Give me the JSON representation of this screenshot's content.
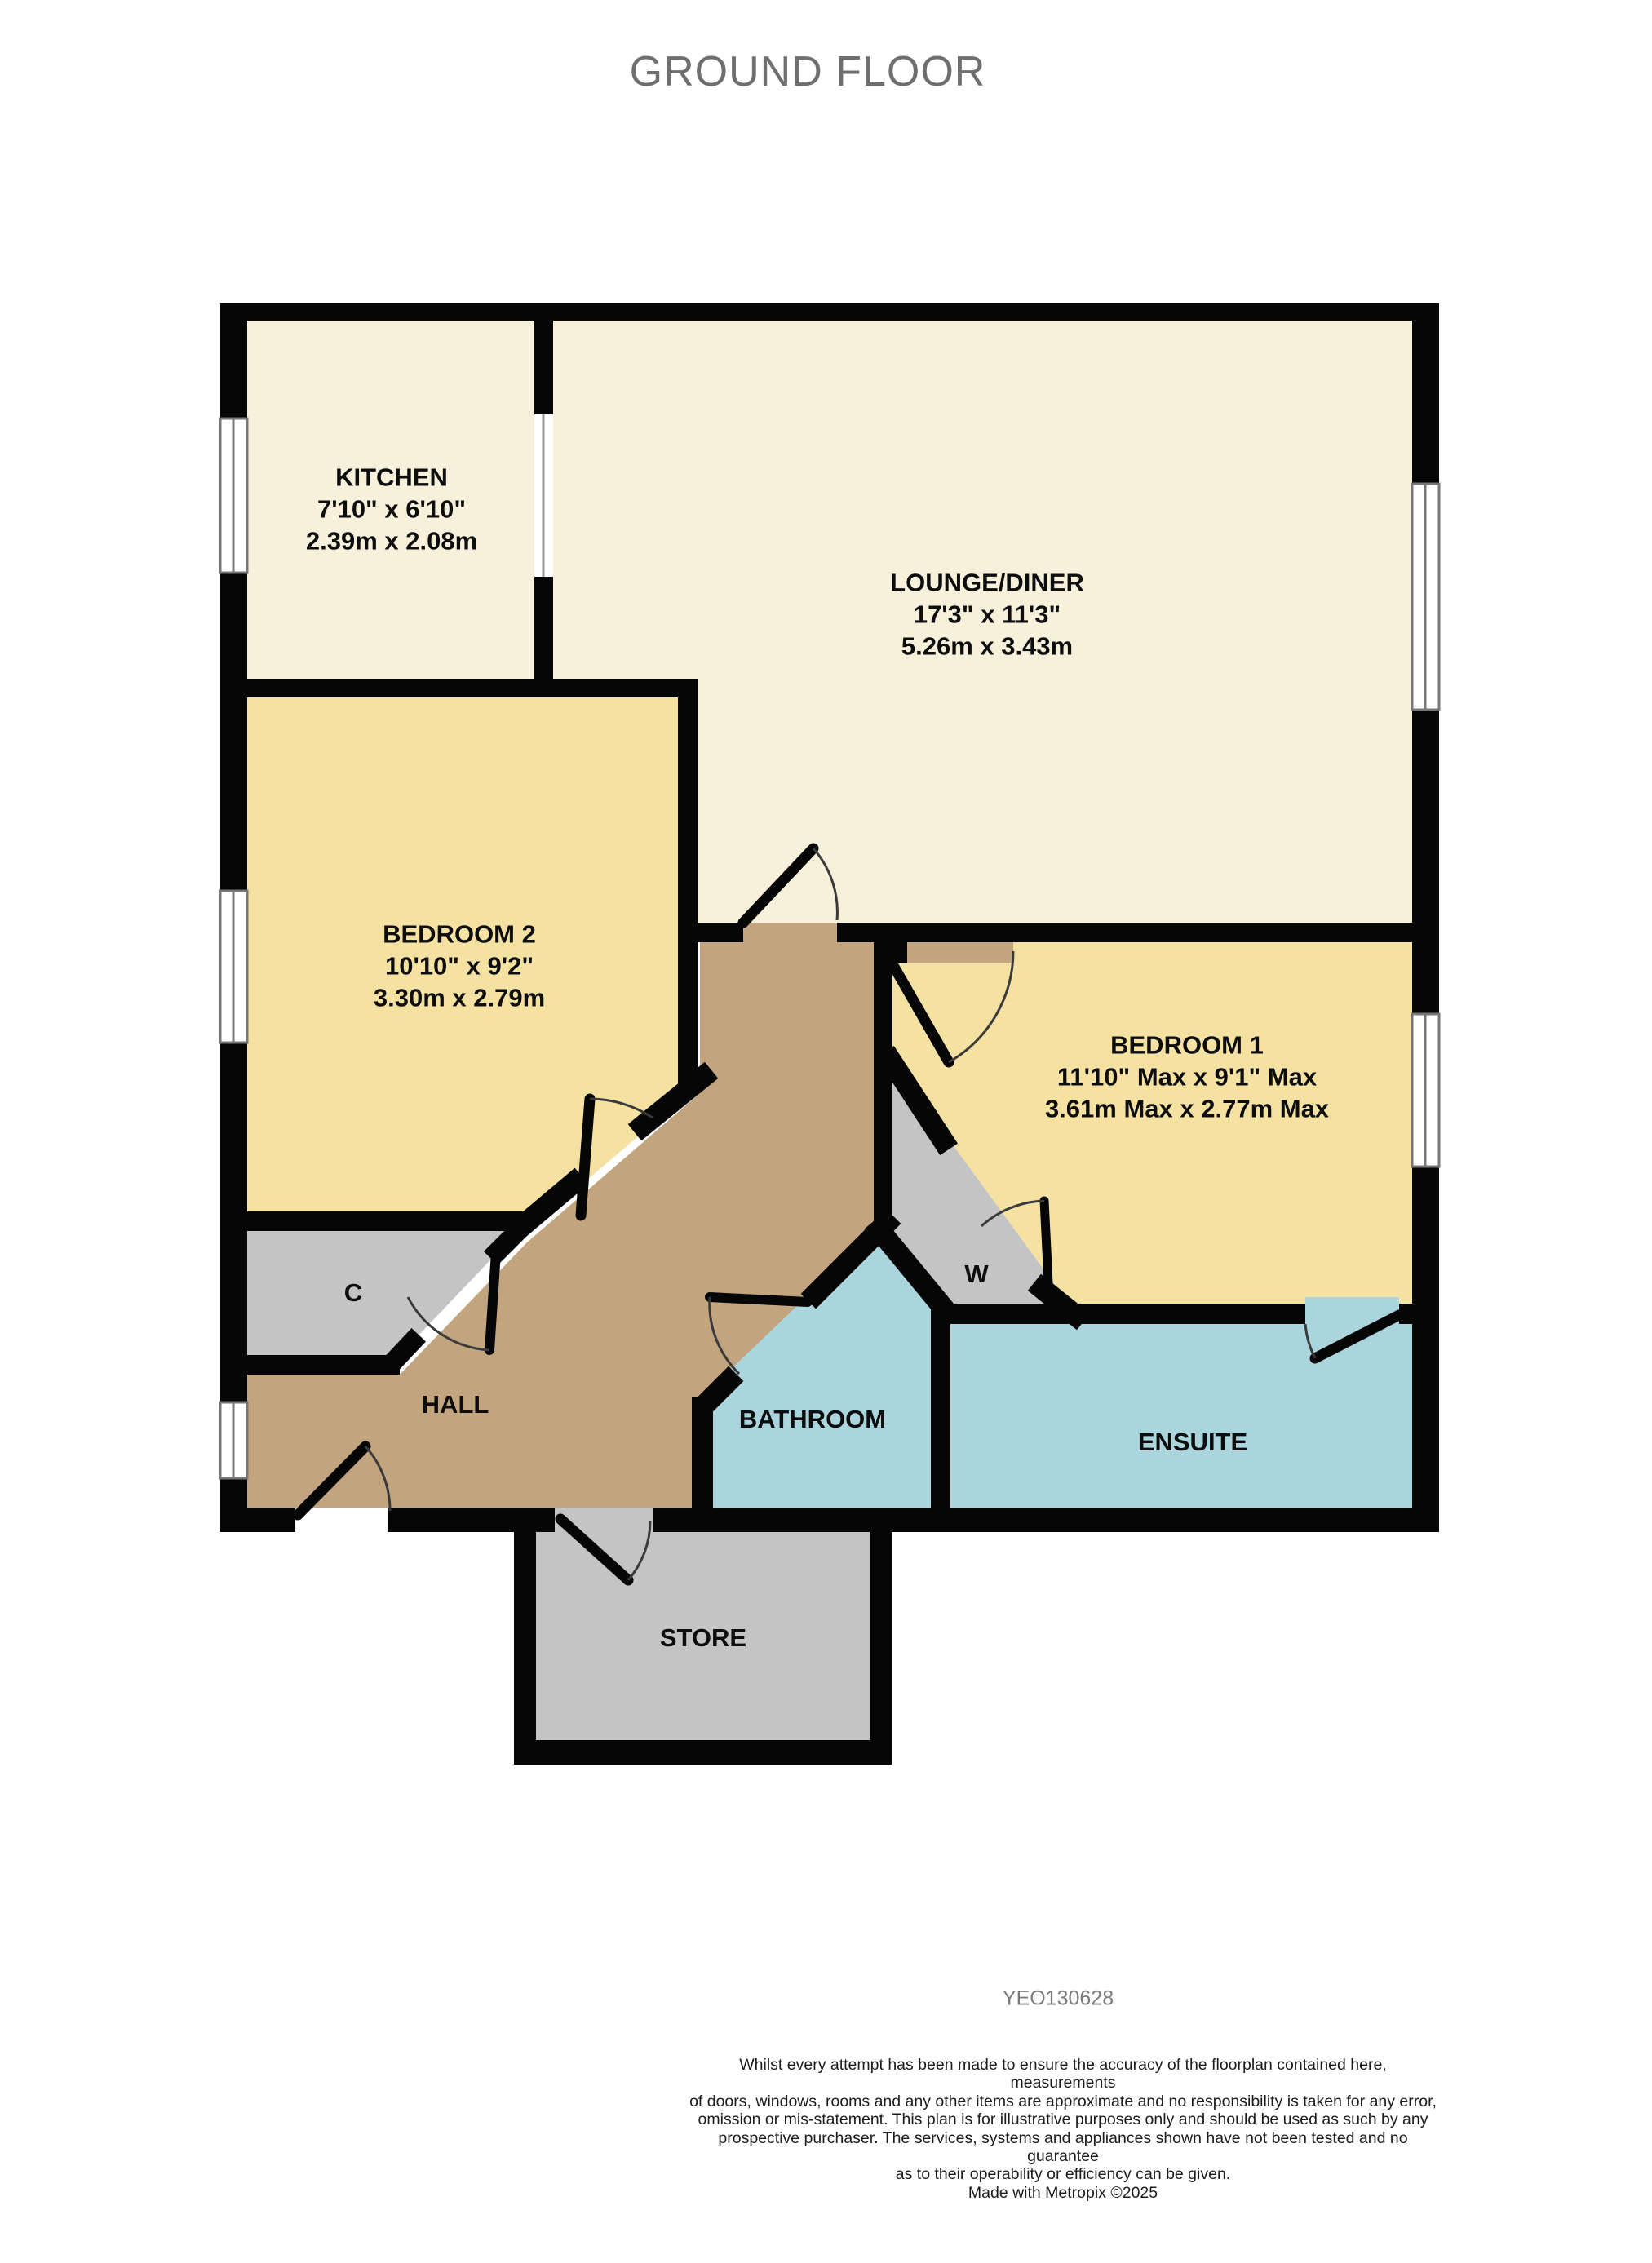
{
  "title": "GROUND FLOOR",
  "reference": "YEO130628",
  "rooms": {
    "kitchen": {
      "name": "KITCHEN",
      "imperial": "7'10\"  x 6'10\"",
      "metric": "2.39m  x 2.08m"
    },
    "lounge": {
      "name": "LOUNGE/DINER",
      "imperial": "17'3\"  x 11'3\"",
      "metric": "5.26m  x 3.43m"
    },
    "bedroom2": {
      "name": "BEDROOM 2",
      "imperial": "10'10\"  x 9'2\"",
      "metric": "3.30m  x 2.79m"
    },
    "bedroom1": {
      "name": "BEDROOM 1",
      "imperial": "11'10\" Max  x 9'1\" Max",
      "metric": "3.61m Max  x 2.77m Max"
    },
    "hall": {
      "name": "HALL"
    },
    "bathroom": {
      "name": "BATHROOM"
    },
    "ensuite": {
      "name": "ENSUITE"
    },
    "store": {
      "name": "STORE"
    },
    "cupboard": {
      "name": "C"
    },
    "wardrobe": {
      "name": "W"
    }
  },
  "disclaimer": {
    "lines": [
      "Whilst every attempt has been made to ensure the accuracy of the floorplan contained here, measurements",
      "of doors, windows, rooms and any other items are approximate and no responsibility is taken for any error,",
      "omission or mis-statement. This plan is for illustrative purposes only and should be used as such by any",
      "prospective purchaser. The services, systems and appliances shown have not been tested and no guarantee",
      "as to their operability or efficiency can be given."
    ],
    "credit": "Made with Metropix ©2025"
  },
  "colors": {
    "wall": "#060606",
    "cream": "#F7F1DC",
    "yellow": "#F5E2A2",
    "hall_tan": "#C2A57F",
    "closet_gray": "#C4C4C4",
    "wet_blue": "#ABD5DD",
    "window_frame": "#777777",
    "arc": "#3a3a3a"
  }
}
